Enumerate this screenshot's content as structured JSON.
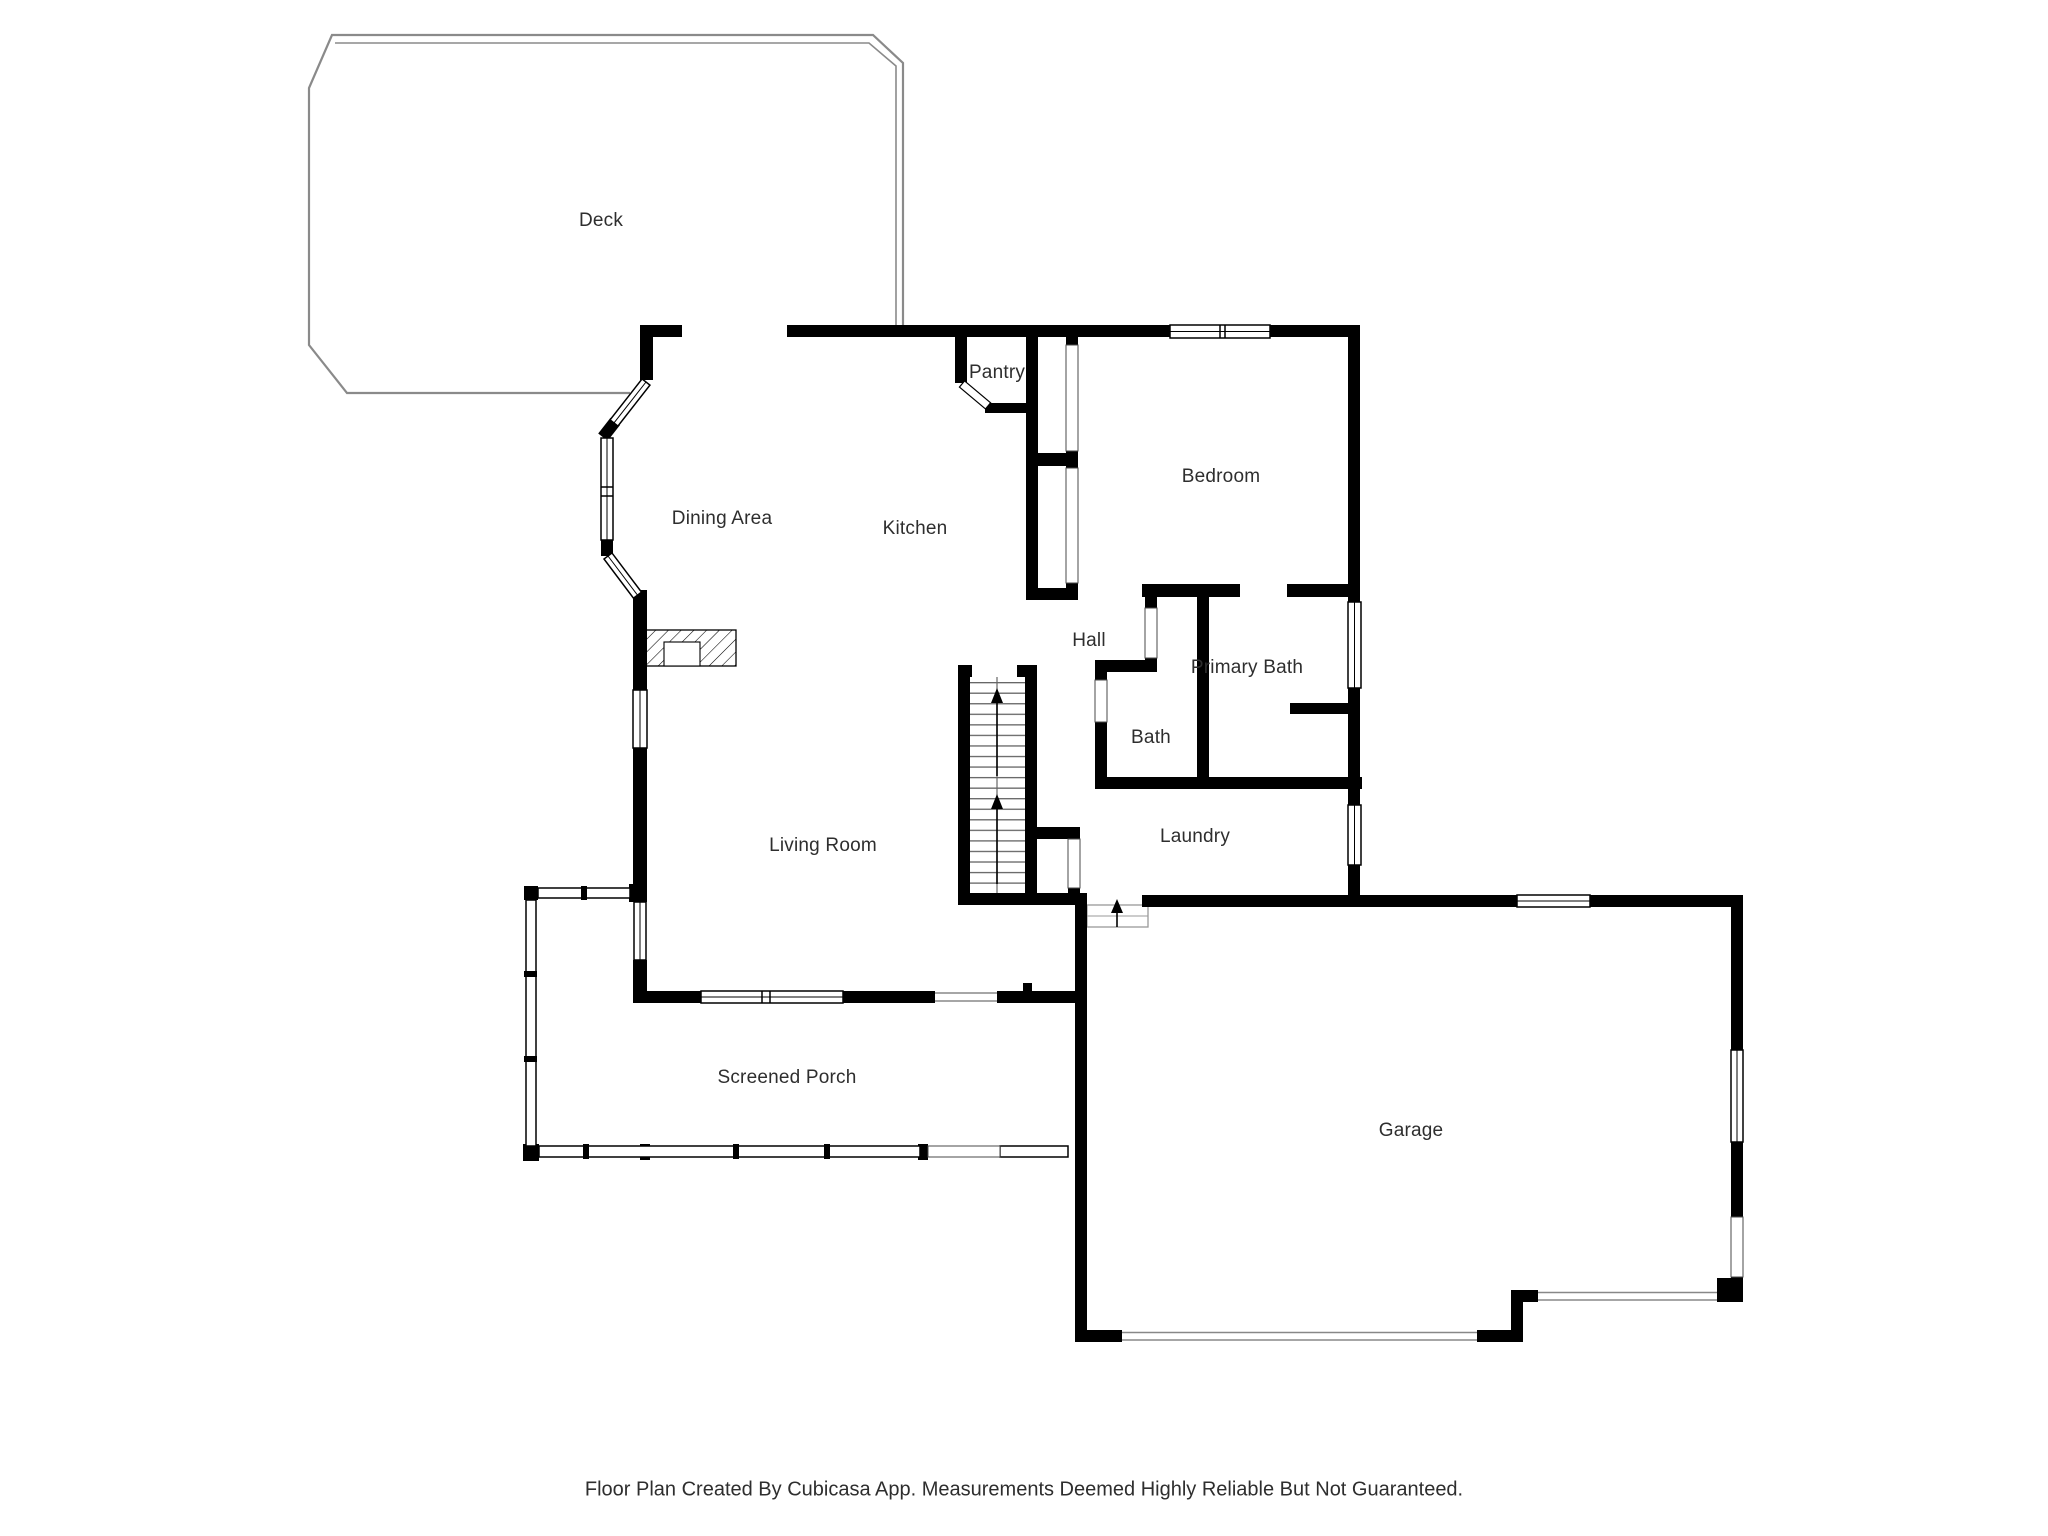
{
  "floor_plan": {
    "source_app_note": "Floor Plan Created By Cubicasa App. Measurements Deemed Highly Reliable But Not Guaranteed.",
    "rooms": [
      {
        "id": "deck",
        "label": "Deck"
      },
      {
        "id": "dining-area",
        "label": "Dining Area"
      },
      {
        "id": "kitchen",
        "label": "Kitchen"
      },
      {
        "id": "pantry",
        "label": "Pantry"
      },
      {
        "id": "bedroom",
        "label": "Bedroom"
      },
      {
        "id": "hall",
        "label": "Hall"
      },
      {
        "id": "primary-bath",
        "label": "Primary Bath"
      },
      {
        "id": "bath",
        "label": "Bath"
      },
      {
        "id": "living-room",
        "label": "Living Room"
      },
      {
        "id": "laundry",
        "label": "Laundry"
      },
      {
        "id": "screened-porch",
        "label": "Screened Porch"
      },
      {
        "id": "garage",
        "label": "Garage"
      }
    ],
    "footer": {
      "text": "Floor Plan Created By Cubicasa App. Measurements Deemed Highly Reliable But Not Guaranteed."
    },
    "stairs": {
      "direction_arrows": 2
    },
    "colors": {
      "wall": "#000000",
      "deck_outline": "#8a8a8a",
      "label_text": "#2e2e2e",
      "stair_lines": "#666666",
      "threshold": "#888888"
    }
  }
}
